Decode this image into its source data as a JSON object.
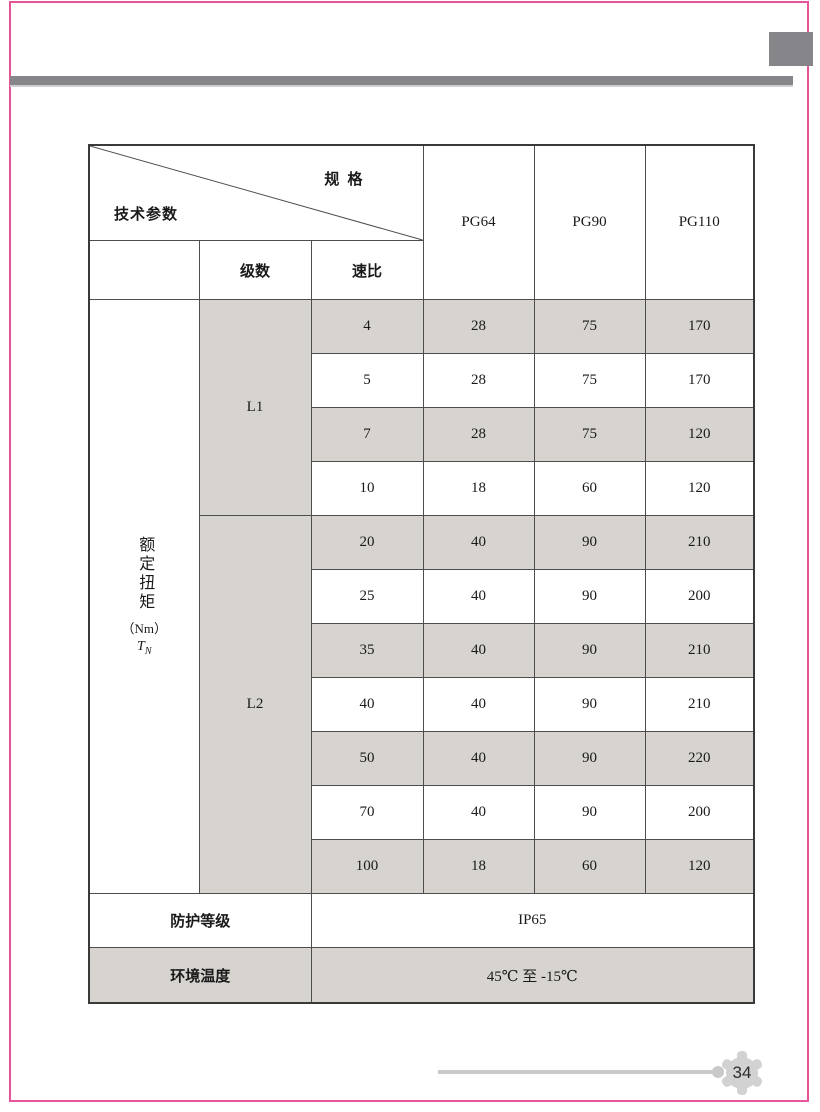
{
  "page": {
    "number": "34"
  },
  "colors": {
    "accent_pink": "#e8549a",
    "bar_gray": "#86868a",
    "cell_gray": "#d7d3ce",
    "line_gray": "#c9c9c9"
  },
  "table": {
    "corner": {
      "top_right": "规 格",
      "bottom_left": "技术参数"
    },
    "col_headers": [
      "PG64",
      "PG90",
      "PG110"
    ],
    "sub_headers": {
      "stage": "级数",
      "ratio": "速比"
    },
    "torque_label": {
      "vertical": "额定扭矩",
      "unit": "（Nm）",
      "symbol": "T",
      "symbol_sub": "N"
    },
    "groups": {
      "l1": "L1",
      "l2": "L2"
    },
    "rows": [
      {
        "ratio": "4",
        "pg64": "28",
        "pg90": "75",
        "pg110": "170"
      },
      {
        "ratio": "5",
        "pg64": "28",
        "pg90": "75",
        "pg110": "170"
      },
      {
        "ratio": "7",
        "pg64": "28",
        "pg90": "75",
        "pg110": "120"
      },
      {
        "ratio": "10",
        "pg64": "18",
        "pg90": "60",
        "pg110": "120"
      },
      {
        "ratio": "20",
        "pg64": "40",
        "pg90": "90",
        "pg110": "210"
      },
      {
        "ratio": "25",
        "pg64": "40",
        "pg90": "90",
        "pg110": "200"
      },
      {
        "ratio": "35",
        "pg64": "40",
        "pg90": "90",
        "pg110": "210"
      },
      {
        "ratio": "40",
        "pg64": "40",
        "pg90": "90",
        "pg110": "210"
      },
      {
        "ratio": "50",
        "pg64": "40",
        "pg90": "90",
        "pg110": "220"
      },
      {
        "ratio": "70",
        "pg64": "40",
        "pg90": "90",
        "pg110": "200"
      },
      {
        "ratio": "100",
        "pg64": "18",
        "pg90": "60",
        "pg110": "120"
      }
    ],
    "protection": {
      "label": "防护等级",
      "value": "IP65"
    },
    "temperature": {
      "label": "环境温度",
      "value": "45℃ 至 -15℃"
    }
  }
}
